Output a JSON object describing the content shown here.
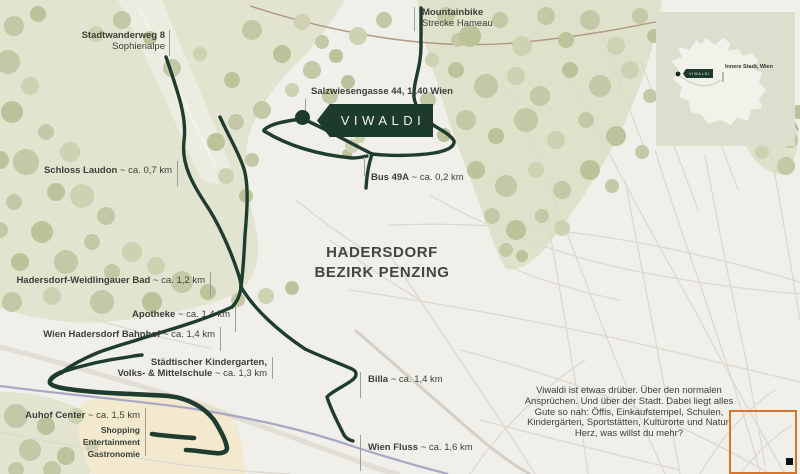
{
  "map": {
    "region": {
      "line1": "HADERSDORF",
      "line2": "BEZIRK PENZING"
    },
    "banner": {
      "label": "VIWALDI"
    },
    "pois": {
      "stadtwanderweg": {
        "name": "Stadtwanderweg 8",
        "sub": "Sophienalpe"
      },
      "mountainbike": {
        "name": "Mountainbike",
        "sub": "Strecke Hameau"
      },
      "address": {
        "text": "Salzwiesengasse 44, 1140 Wien"
      },
      "schloss": {
        "name": "Schloss Laudon",
        "distance": "~ ca. 0,7 km"
      },
      "bus": {
        "name": "Bus 49A",
        "distance": "~ ca. 0,2 km"
      },
      "bad": {
        "name": "Hadersdorf-Weidlingauer Bad",
        "distance": "~ ca. 1,2 km"
      },
      "apotheke": {
        "name": "Apotheke",
        "distance": "~ ca. 1,4 km"
      },
      "bahnhof": {
        "name": "Wien Hadersdorf Bahnhof",
        "distance": "~ ca. 1,4 km"
      },
      "kindergarten": {
        "line1": "Städtischer Kindergarten,",
        "name2": "Volks- & Mittelschule",
        "distance2": "~ ca. 1,3 km"
      },
      "billa": {
        "name": "Billa",
        "distance": "~ ca. 1,4 km"
      },
      "auhof": {
        "name": "Auhof Center",
        "distance": "~ ca. 1,5 km",
        "tags": [
          "Shopping",
          "Entertainment",
          "Gastronomie"
        ]
      },
      "fluss": {
        "name": "Wien Fluss",
        "distance": "~ ca. 1,6 km"
      }
    },
    "inset": {
      "tag": "VIWALDI",
      "label": "Innere Stadt, Wien"
    },
    "description": {
      "text": "Viwaldi ist etwas drüber. Über den normalen Ansprüchen. Und über der Stadt. Dabei liegt alles Gute so nah: Öffis, Einkaufstempel, Schulen, Kindergärten, Sportstätten, Kulturorte und Natur. Herz, was willst du mehr?"
    },
    "colors": {
      "background": "#f0efe9",
      "forest": "#dfe2cb",
      "tree": "#c4c8a6",
      "road_dark_green": "#1f3d2e",
      "banner_green": "#1c3b2b",
      "river_purple": "#a9a8c5",
      "auhof_beige": "#f2e9cf",
      "annotation_orange": "#d4772c"
    }
  }
}
